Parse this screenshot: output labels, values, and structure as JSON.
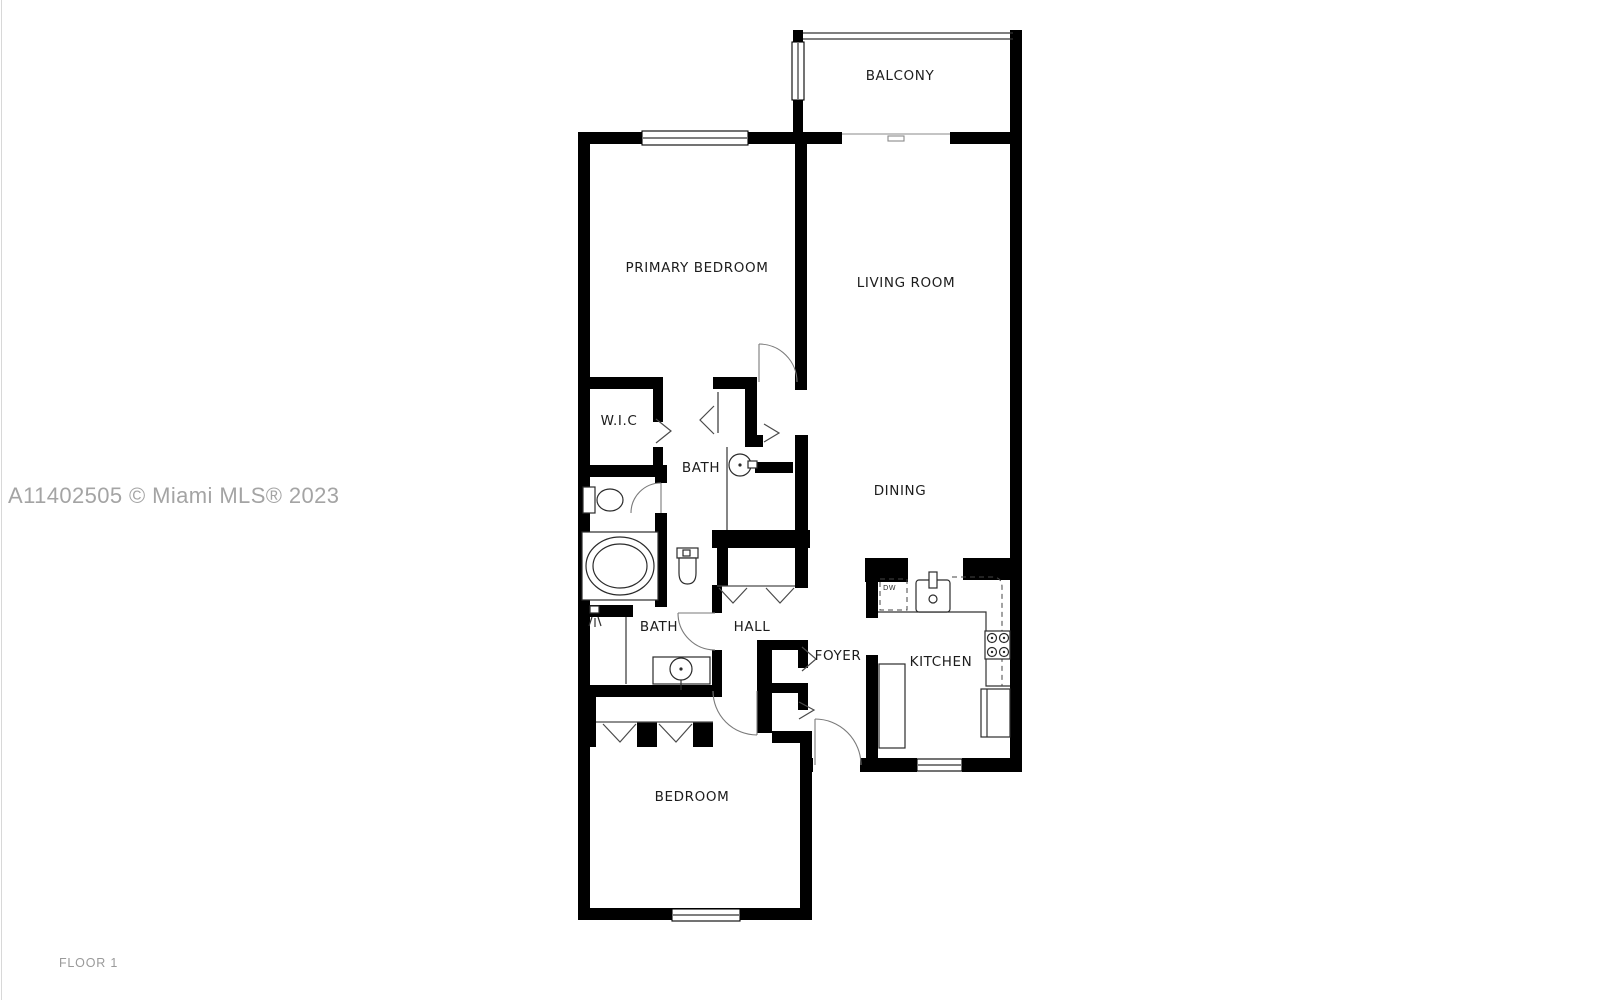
{
  "floor_plan": {
    "rooms": {
      "balcony": "BALCONY",
      "primary_bedroom": "PRIMARY BEDROOM",
      "living_room": "LIVING ROOM",
      "wic": "W.I.C",
      "bath_primary": "BATH",
      "dining": "DINING",
      "bath_hall": "BATH",
      "hall": "HALL",
      "foyer": "FOYER",
      "kitchen": "KITCHEN",
      "bedroom": "BEDROOM"
    },
    "appliance_labels": {
      "dishwasher": "DW"
    }
  },
  "watermark": "A11402505 © Miami MLS® 2023",
  "floor_label": "FLOOR 1",
  "colors": {
    "wall": "#000000",
    "room_label": "#1c1c1c",
    "watermark": "#a4a4a4",
    "floor_label": "#9a9a9a",
    "background": "#ffffff"
  }
}
